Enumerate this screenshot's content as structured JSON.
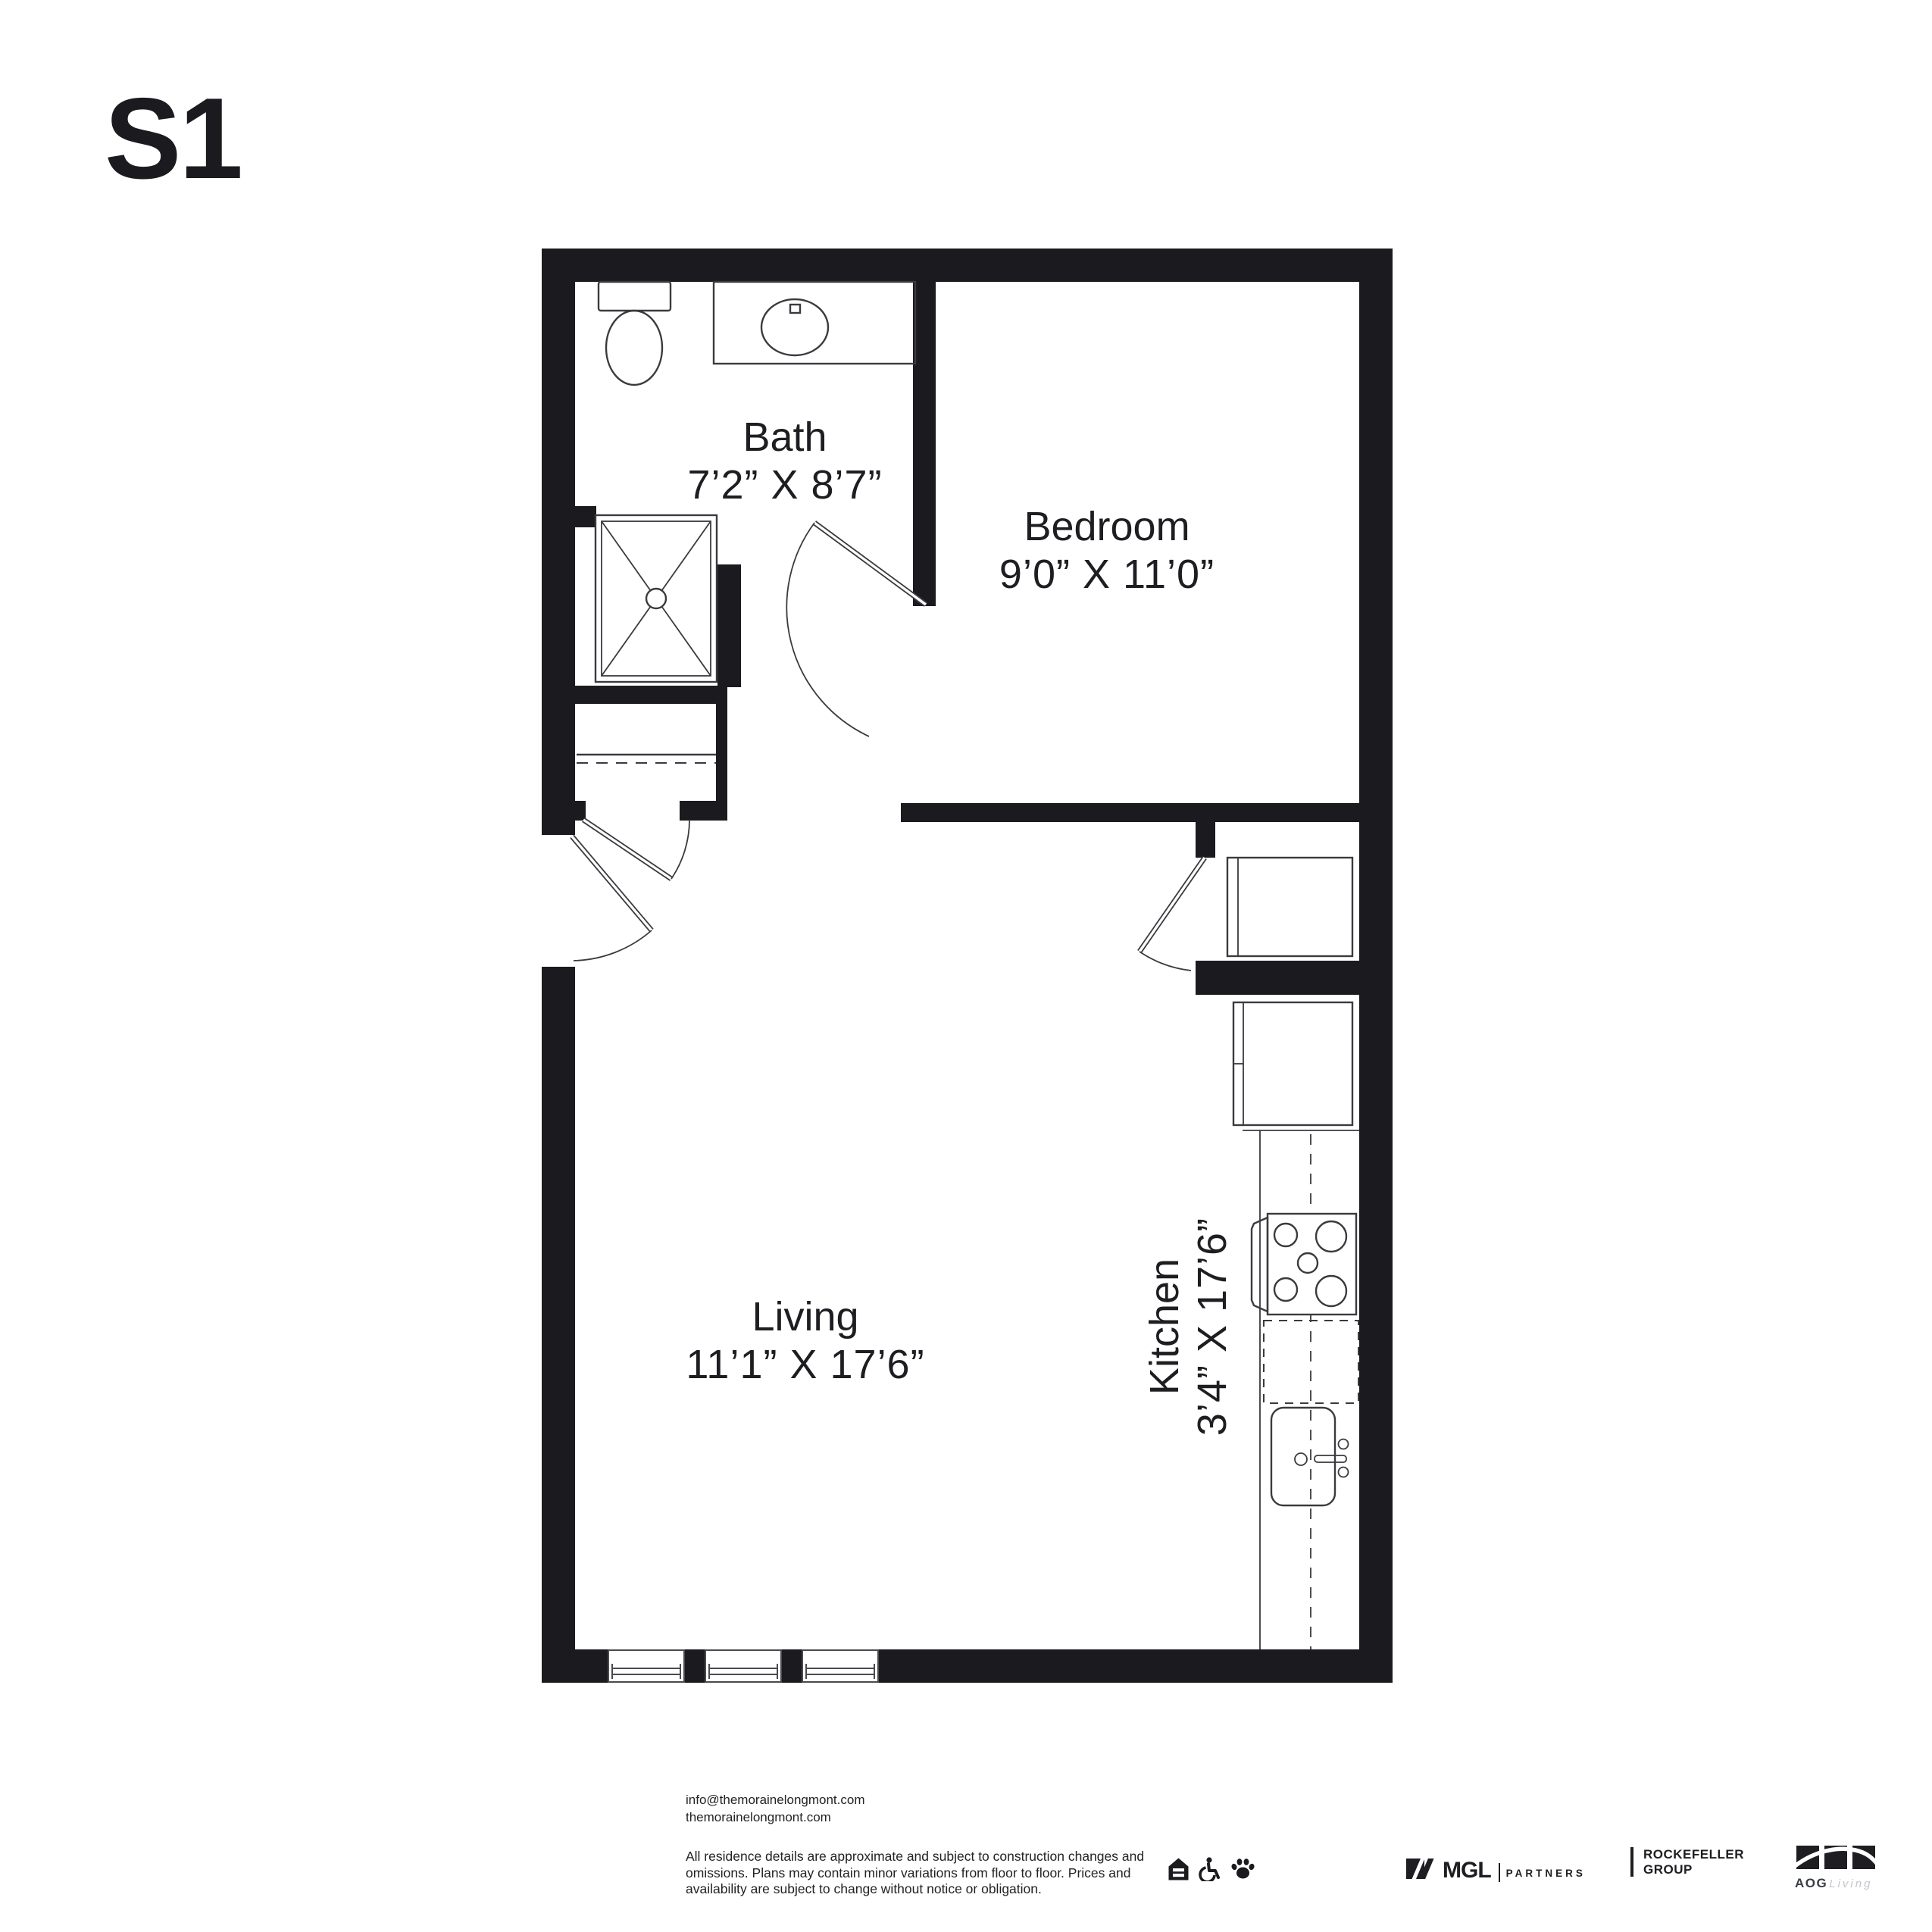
{
  "title": "S1",
  "rooms": [
    {
      "name": "Bath",
      "dims": "7’2” X 8’7”"
    },
    {
      "name": "Bedroom",
      "dims": "9’0” X 11’0”"
    },
    {
      "name": "Living",
      "dims": "11’1” X 17’6”"
    },
    {
      "name": "Kitchen",
      "dims": "3’4” X 17’6”"
    }
  ],
  "footer": {
    "contact": "info@themorainelongmont.com\nthemorainelongmont.com",
    "disclaimer": "All residence details are approximate and subject to construction changes and\nomissions. Plans may contain minor variations from floor to floor. Prices and\navailability are subject to change without notice or obligation.",
    "amenity_icons": [
      "equal-housing-icon",
      "wheelchair-accessible-icon",
      "pet-friendly-paw-icon"
    ],
    "logos": {
      "mgl": {
        "name": "MGL",
        "suffix": "PARTNERS"
      },
      "rockefeller": {
        "line1": "ROCKEFELLER",
        "line2": "GROUP"
      },
      "aog": {
        "name": "AOG",
        "suffix": "Living"
      }
    }
  },
  "colors": {
    "wall": "#1b1b1f",
    "line": "#3a3a3f",
    "text": "#1e1e22",
    "aog_living": "#c2c5cb"
  }
}
